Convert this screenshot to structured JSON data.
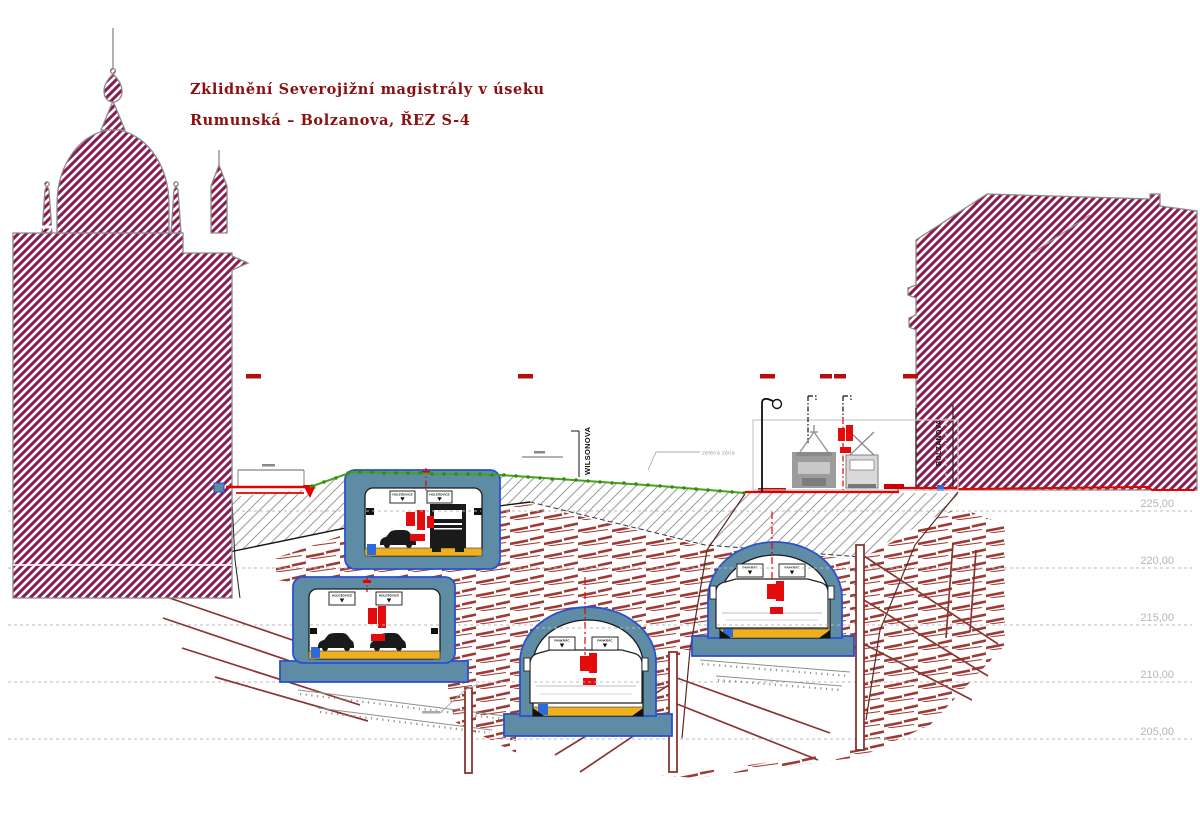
{
  "title": {
    "line1": "Zklidnění Severojižní magistrály v úseku",
    "line2": "Rumunská – Bolzanova, ŘEZ S-4"
  },
  "grid": {
    "elevations": [
      "225,00",
      "220,00",
      "215,00",
      "210,00",
      "205,00"
    ]
  },
  "labels": {
    "street_center": "WILSONOVA",
    "street_right": "BOLZANOVA",
    "surface_note": "zelená zóna"
  },
  "tunnels": {
    "box_upper": {
      "sign_left": "HOLEŠOVICE",
      "sign_right": "HOLEŠOVICE"
    },
    "box_lower": {
      "sign_left": "HOLEŠOVICE",
      "sign_right": "HOLEŠOVICE"
    },
    "arch_middle": {
      "sign_left": "PANKRÁC",
      "sign_right": "PANKRÁC"
    },
    "arch_right": {
      "sign_left": "PANKRÁC",
      "sign_right": "PANKRÁC"
    }
  },
  "colors": {
    "building": "#8E1A4D",
    "structure": "#5E8CA4",
    "structure_outline": "#2B50D0",
    "roadway": "#F0B01E",
    "vegetation": "#3F9A1C",
    "rock": "#9E3A33",
    "soil_hatch": "#9A9A9A",
    "accent_red": "#E60000",
    "title_red": "#8B1111",
    "gridline": "#B8B8B8"
  }
}
